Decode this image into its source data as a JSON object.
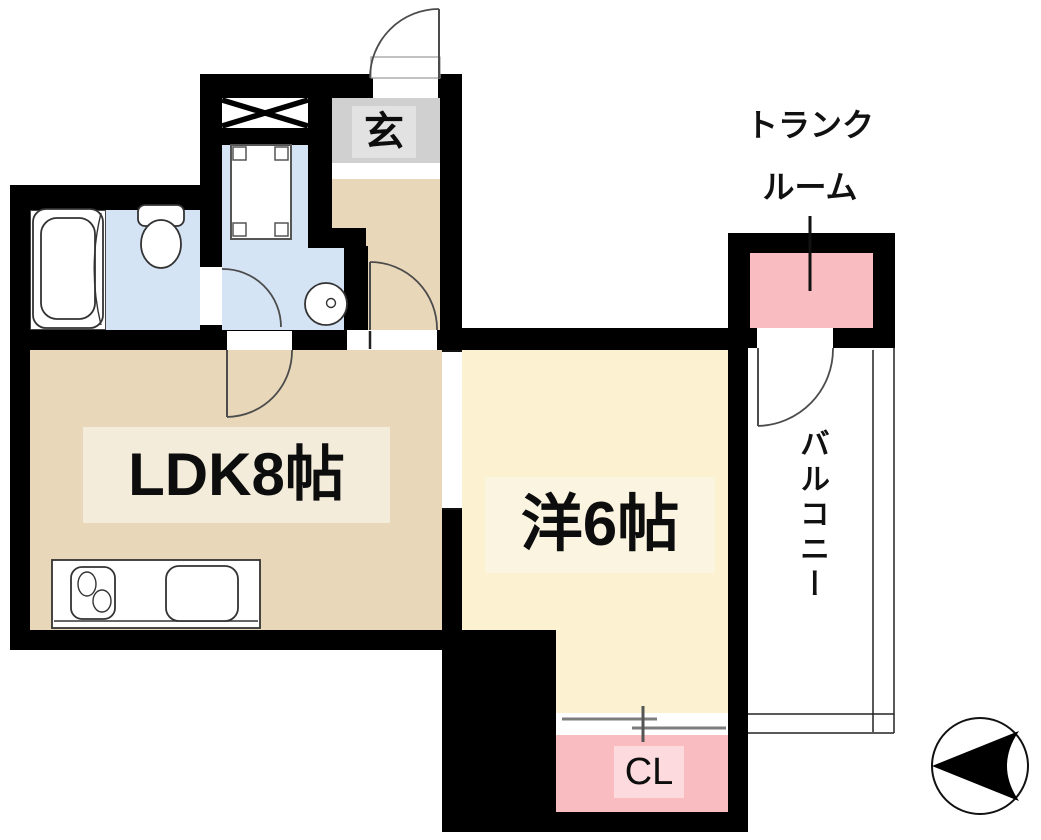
{
  "page": {
    "kind": "Japanese apartment floor plan",
    "background_color": "#ffffff",
    "wall_color": "#000000"
  },
  "rooms": {
    "ldk": {
      "label": "LDK8帖",
      "floor_color": "#e9d7ba",
      "label_bg": "#f3ecda"
    },
    "western_room": {
      "label": "洋6帖",
      "floor_color": "#fcf2d2",
      "label_bg": "#fbf4e1"
    },
    "entrance": {
      "label": "玄",
      "floor_color": "#d0d0d0",
      "label_bg": "#e2e2e2"
    },
    "closet": {
      "label": "CL",
      "floor_color": "#f9bcc0",
      "label_bg": "#fcdadd"
    },
    "trunk_room": {
      "label_line1": "トランク",
      "label_line2": "ルーム",
      "floor_color": "#f9bcc0"
    },
    "balcony": {
      "label": "バルコニー",
      "floor_color": "#ffffff"
    },
    "washroom": {
      "floor_color": "#d4e4f5"
    },
    "toilet_room": {
      "floor_color": "#d4e4f5"
    },
    "bathroom": {
      "floor_color": "#ffffff"
    }
  },
  "fixtures": [
    "bathtub",
    "toilet",
    "wash-basin",
    "washing-machine-space",
    "pipe-shaft-x",
    "kitchen-counter",
    "stove-burners",
    "sink",
    "sliding-closet-door",
    "hinged-doors",
    "north-arrow-compass",
    "trunk-room-leader-line",
    "balcony-railing"
  ],
  "colors": {
    "wall": "#000000",
    "beige_floor": "#e9d7ba",
    "cream_floor": "#fcf2d2",
    "blue_floor": "#d4e4f5",
    "gray_floor": "#d0d0d0",
    "pink_floor": "#f9bcc0",
    "door_arc_line": "#4c4c4c",
    "fixture_line": "#333333",
    "sliding_door_line": "#7d7d7d"
  }
}
